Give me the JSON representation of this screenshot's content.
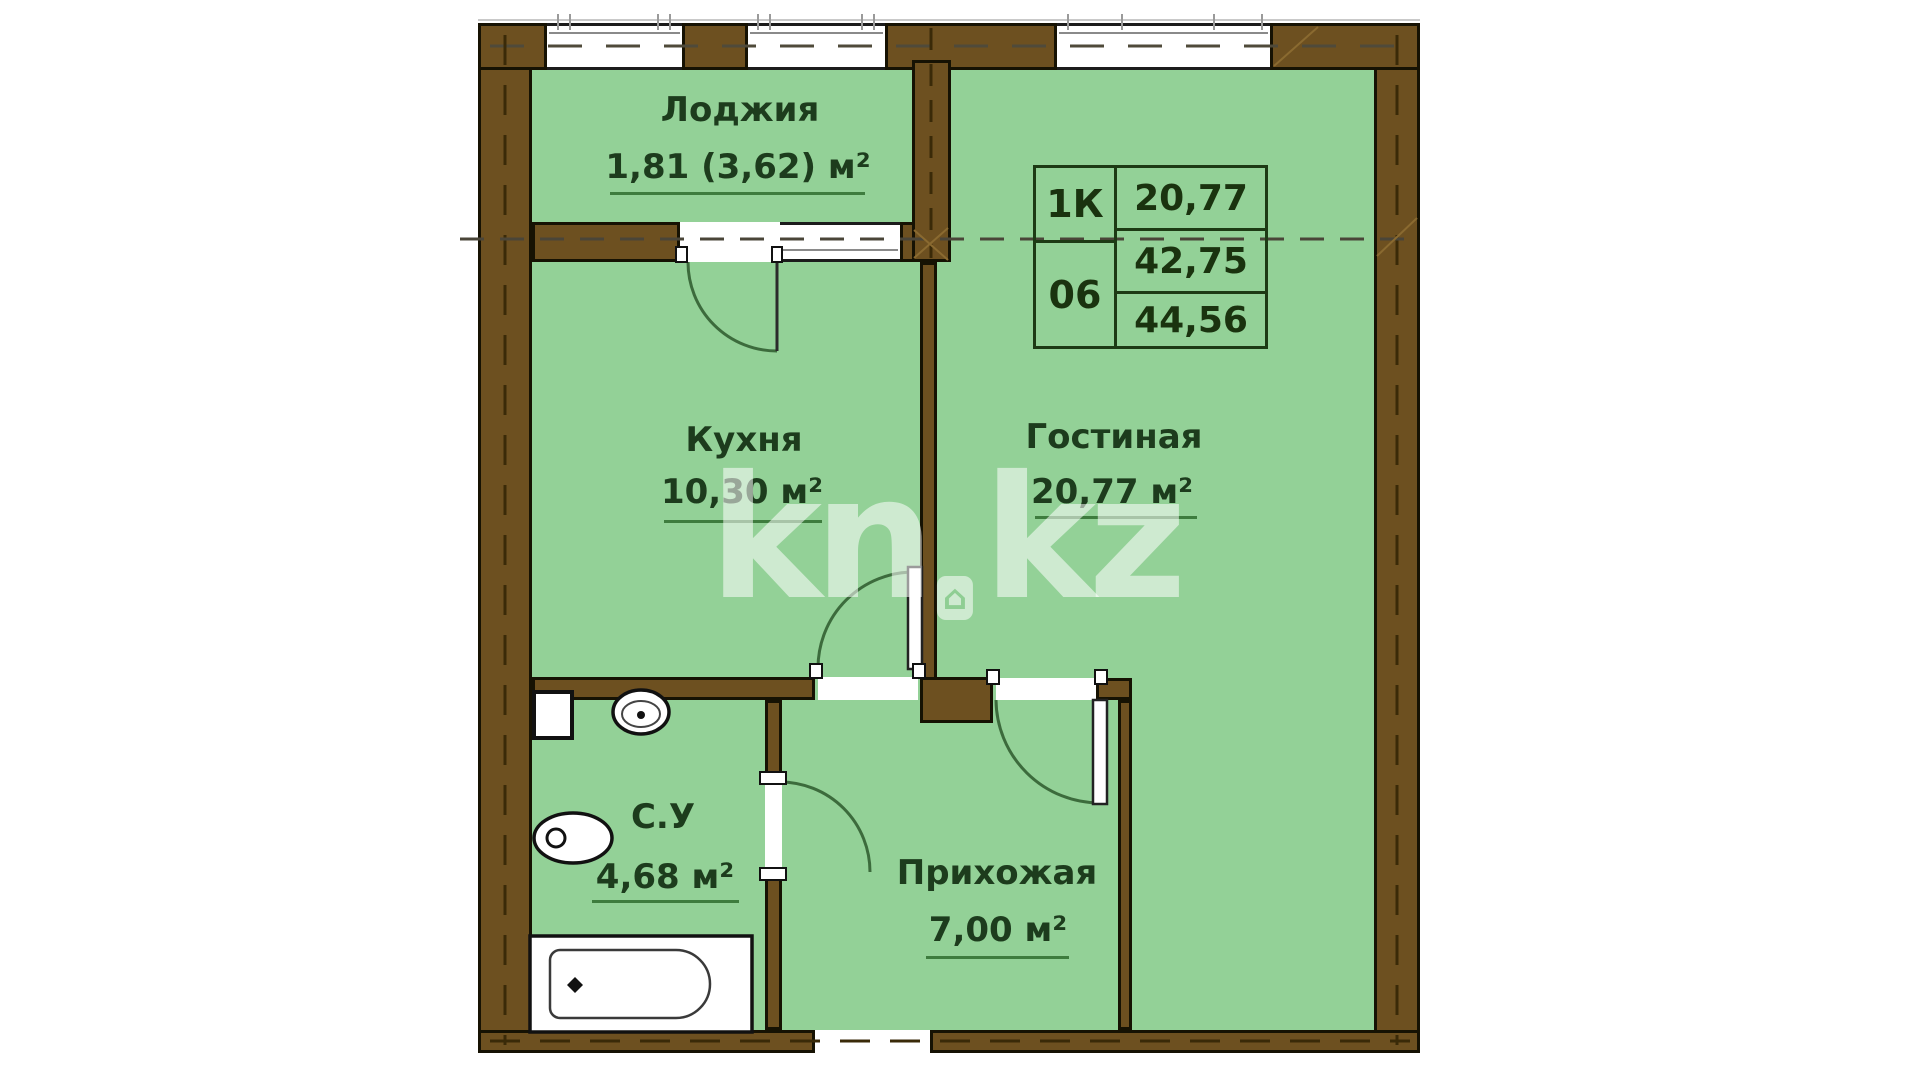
{
  "watermark": {
    "prefix": "kn",
    "suffix": "kz"
  },
  "info_table": {
    "unit_type": "1К",
    "unit_number": "06",
    "living_area": "20,77",
    "area_no_loggia": "42,75",
    "total_area": "44,56"
  },
  "rooms": {
    "loggia": {
      "name": "Лоджия",
      "area": "1,81 (3,62) м²"
    },
    "kitchen": {
      "name": "Кухня",
      "area": "10,30 м²"
    },
    "living": {
      "name": "Гостиная",
      "area": "20,77 м²"
    },
    "bathroom": {
      "name": "С.У",
      "area": "4,68 м²"
    },
    "hallway": {
      "name": "Прихожая",
      "area": "7,00 м²"
    }
  },
  "fixtures": [
    "bathtub",
    "toilet",
    "sink",
    "vent-shaft"
  ],
  "colors": {
    "room_fill": "#93d197",
    "wall_fill": "#6d5020",
    "wall_edge": "#161203",
    "text": "#1d3c1d",
    "swing_line": "#3c6b3c",
    "background": "#ffffff"
  }
}
